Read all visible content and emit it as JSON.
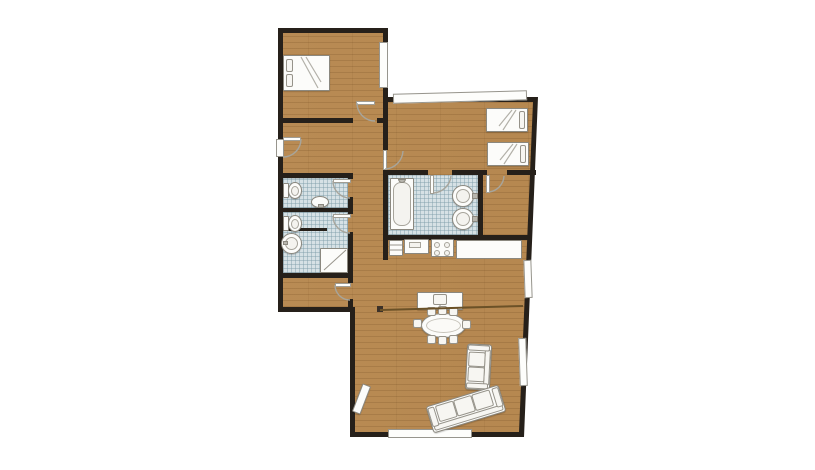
{
  "meta": {
    "title": "Apartment floor plan",
    "canvas": {
      "width": 815,
      "height": 470
    }
  },
  "palette": {
    "wall": "#26201a",
    "wood": "#b9894f",
    "tile": "#d6e1e5",
    "tile_grid": "rgba(125,156,168,0.45)",
    "fixture": "#fcfcfa",
    "fixture_border": "#8b887f",
    "partition": "#6b5127",
    "background": "#ffffff"
  },
  "rooms": [
    {
      "id": "bedroom-main",
      "type": "bedroom",
      "floor": "wood",
      "furniture": [
        "double-bed"
      ]
    },
    {
      "id": "hallway",
      "type": "hall",
      "floor": "wood",
      "furniture": []
    },
    {
      "id": "wc",
      "type": "toilet-room",
      "floor": "tile",
      "furniture": [
        "toilet",
        "washbasin"
      ]
    },
    {
      "id": "shower-room",
      "type": "bathroom",
      "floor": "tile",
      "furniture": [
        "toilet",
        "pedestal-sink",
        "shower-cabin"
      ]
    },
    {
      "id": "lower-hall",
      "type": "hall",
      "floor": "wood",
      "furniture": []
    },
    {
      "id": "bedroom-twin",
      "type": "bedroom",
      "floor": "wood",
      "furniture": [
        "single-bed",
        "single-bed"
      ]
    },
    {
      "id": "bathroom-main",
      "type": "bathroom",
      "floor": "tile",
      "furniture": [
        "bathtub",
        "washbasin",
        "washbasin"
      ]
    },
    {
      "id": "storage",
      "type": "closet",
      "floor": "wood",
      "furniture": []
    },
    {
      "id": "living-dining-kitchen",
      "type": "open-plan room",
      "floor": "wood",
      "furniture": [
        "kitchen-cabinet",
        "kitchen-sink-unit",
        "stove-4-burner",
        "kitchen-counter",
        "tv-sideboard",
        "oval-dining-table",
        "8-dining-chairs",
        "two-seat-sofa",
        "three-seat-sofa",
        "console-bench"
      ]
    }
  ],
  "inventory": {
    "beds_double": 1,
    "beds_single": 2,
    "toilets": 2,
    "washbasins": 4,
    "bathtubs": 1,
    "showers": 1,
    "windows": 5,
    "door_swings": 8,
    "dining_chairs": 8
  }
}
